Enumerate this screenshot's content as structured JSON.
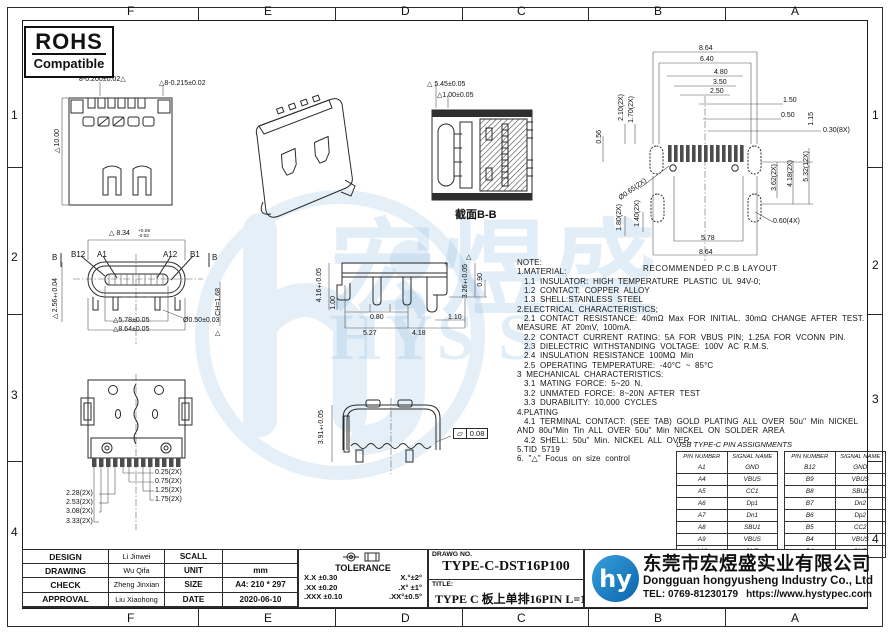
{
  "colors": {
    "line": "#2b2b2b",
    "accent_blue": "#1b7fc4",
    "watermark": "#7fb4dd"
  },
  "border": {
    "top_letters": [
      "F",
      "E",
      "D",
      "C",
      "B",
      "A"
    ],
    "bottom_letters": [
      "F",
      "E",
      "D",
      "C",
      "B",
      "A"
    ],
    "left_numbers": [
      "1",
      "2",
      "3",
      "4"
    ],
    "right_numbers": [
      "1",
      "2",
      "3",
      "4"
    ]
  },
  "rohs": {
    "title": "ROHS",
    "subtitle": "Compatible"
  },
  "views": {
    "top_view": {
      "dims": {
        "d1": "8-0.200±0.02△",
        "d2": "△8-0.215±0.02",
        "d3": "▷10.00"
      }
    },
    "section_bb": {
      "label": "截面B-B",
      "dims": {
        "d1": "△ 5.45±0.05",
        "d2": "△1.00±0.05"
      }
    },
    "pcb": {
      "label": "RECOMMENDED  P.C.B  LAYOUT",
      "dims": {
        "t1": "8.64",
        "t2": "6.40",
        "t3": "4.80",
        "t4": "3.50",
        "t5": "2.50",
        "r150": "1.50",
        "r050": "0.50",
        "v115": "1.15",
        "r030": "0.30(8X)",
        "v056": "0.56",
        "v210": "2.10(2X)",
        "v170": "1.70(2X)",
        "d065": "Ø0.65(2X)",
        "v180": "1.80(2X)",
        "v140": "1.40(2X)",
        "v362": "3.62(2X)",
        "v418": "4.18(2X)",
        "v532": "5.32(12X)",
        "d060": "0.60(4X)",
        "b578": "5.78",
        "b864": "8.64"
      }
    },
    "front_view": {
      "labels": {
        "b12": "B12",
        "a1": "A1",
        "a12": "A12",
        "b1": "B1",
        "b_left": "B",
        "b_right": "B"
      },
      "dims": {
        "d834": "△ 8.34",
        "d834_sup": "+0.06",
        "d834_sub": "-0.02",
        "v256": "▷2.56±0.04",
        "d578": "△5.78±0.05",
        "d050": "Ø0.50±0.03",
        "d864": "△8.64±0.05",
        "ch": "CH=1.68",
        "tri": "△"
      }
    },
    "side_view": {
      "dims": {
        "v416": "4.16±0.05",
        "v100": "1.00",
        "d080": "0.80",
        "d110": "1.10",
        "d527": "5.27",
        "d418": "4.18",
        "tri": "△",
        "v326": "3.26±0.05",
        "v090": "0.90"
      }
    },
    "bottom_view": {
      "dims": {
        "r1": "0.25(2X)",
        "r2": "0.75(2X)",
        "r3": "1.25(2X)",
        "r4": "1.75(2X)",
        "l1": "2.28(2X)",
        "l2": "2.53(2X)",
        "l3": "3.08(2X)",
        "l4": "3.33(2X)"
      }
    },
    "rear_view": {
      "dims": {
        "v391": "3.91±0.05",
        "flat_sym": "▱",
        "flat_val": "0.08"
      }
    }
  },
  "notes": {
    "lines": [
      "NOTE:",
      "1.MATERIAL:",
      "   1.1  INSULATOR:  HIGH  TEMPERATURE  PLASTIC  UL  94V-0;",
      "   1.2  CONTACT:  COPPER  ALLOY",
      "   1.3  SHELL:STAINLESS  STEEL",
      "2.ELECTRICAL  CHARACTERISTICS;",
      "   2.1  CONTACT  RESISTANCE:  40mΩ  Max  FOR  INITIAL.  30mΩ  CHANGE  AFTER  TEST.",
      "MEASURE  AT  20mV,  100mA.",
      "   2.2  CONTACT  CURRENT  RATING:  5A  FOR  VBUS  PIN;  1.25A  FOR  VCONN  PIN.",
      "   2.3  DIELECTRIC  WITHSTANDING  VOLTAGE:  100V  AC  R.M.S.",
      "   2.4  INSULATION  RESISTANCE  100MΩ  Min",
      "   2.5  OPERATING  TEMPERATURE:  -40°C  ~  85°C",
      "3  MECHANICAL  CHARACTERISTICS:",
      "   3.1  MATING  FORCE:  5~20  N.",
      "   3.2  UNMATED  FORCE:  8~20N  AFTER  TEST",
      "   3.3  DURABILITY:  10,000  CYCLES",
      "4.PLATING",
      "   4.1  TERMINAL  CONTACT:  (SEE  TAB)  GOLD  PLATING  ALL  OVER  50u\"  Min  NICKEL",
      "AND  80u\"Min  Tin  ALL  OVER  50u\"  Min  NICKEL  ON  SOLDER  AREA",
      "   4.2  SHELL:  50u\"  Min.  NICKEL  ALL  OVER,",
      "5.TID  5719",
      "6.  \"△\"  Focus  on  size  control"
    ]
  },
  "pin_table": {
    "title": "USB TYPE-C PIN ASSIGNMENTS",
    "headers": [
      "PIN NUMBER",
      "SIGNAL NAME"
    ],
    "left_rows": [
      [
        "A1",
        "GND"
      ],
      [
        "A4",
        "VBUS"
      ],
      [
        "A5",
        "CC1"
      ],
      [
        "A6",
        "Dp1"
      ],
      [
        "A7",
        "Dn1"
      ],
      [
        "A8",
        "SBU1"
      ],
      [
        "A9",
        "VBUS"
      ],
      [
        "A12",
        "GND"
      ]
    ],
    "right_rows": [
      [
        "B12",
        "GND"
      ],
      [
        "B9",
        "VBUS"
      ],
      [
        "B8",
        "SBU2"
      ],
      [
        "B7",
        "Dn2"
      ],
      [
        "B6",
        "Dp2"
      ],
      [
        "B5",
        "CC2"
      ],
      [
        "B4",
        "VBUS"
      ],
      [
        "B1",
        "GND"
      ]
    ]
  },
  "title_block": {
    "rows": [
      {
        "label": "DESIGN",
        "name": "Li Jinwei",
        "field": "SCALL",
        "value": ""
      },
      {
        "label": "DRAWING",
        "name": "Wu Qifa",
        "field": "UNIT",
        "value": "mm"
      },
      {
        "label": "CHECK",
        "name": "Zheng Jinxian",
        "field": "SIZE",
        "value": "A4: 210 * 297"
      },
      {
        "label": "APPROVAL",
        "name": "Liu Xiaohong",
        "field": "DATE",
        "value": "2020-06-10"
      }
    ],
    "tolerance": {
      "title": "TOLERANCE",
      "rows": [
        [
          "X.X   ±0.30",
          "X.°±2°"
        ],
        [
          ".XX   ±0.20",
          ".X° ±1°"
        ],
        [
          ".XXX  ±0.10",
          ".XX°±0.5°"
        ]
      ]
    },
    "drawg_no_label": "DRAWG NO.",
    "drawg_no": "TYPE-C-DST16P100",
    "title_label": "TITLE:",
    "title": "TYPE C 板上单排16PIN L=10.0MM有弹片"
  },
  "company": {
    "logo_text": "hy",
    "cn": "东莞市宏煜盛实业有限公司",
    "en": "Dongguan hongyusheng Industry Co., Ltd",
    "tel": "TEL: 0769-81230179",
    "url": "https://www.hystypec.com"
  },
  "watermark": {
    "cn": "宏煜盛",
    "en": "HYS S"
  }
}
